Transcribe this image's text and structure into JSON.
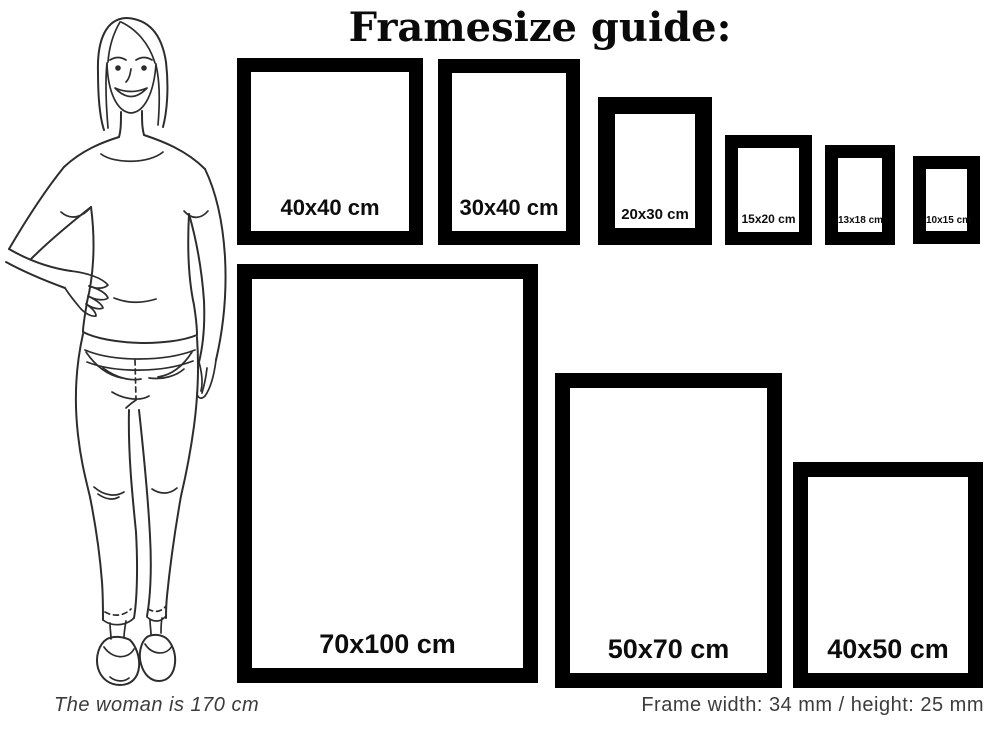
{
  "title": "Framesize guide:",
  "frames": [
    {
      "label": "40x40 cm",
      "width_cm": 40,
      "height_cm": 40
    },
    {
      "label": "30x40 cm",
      "width_cm": 30,
      "height_cm": 40
    },
    {
      "label": "20x30 cm",
      "width_cm": 20,
      "height_cm": 30
    },
    {
      "label": "15x20 cm",
      "width_cm": 15,
      "height_cm": 20
    },
    {
      "label": "13x18 cm",
      "width_cm": 13,
      "height_cm": 18
    },
    {
      "label": "10x15 cm",
      "width_cm": 10,
      "height_cm": 15
    },
    {
      "label": "70x100 cm",
      "width_cm": 70,
      "height_cm": 100
    },
    {
      "label": "50x70 cm",
      "width_cm": 50,
      "height_cm": 70
    },
    {
      "label": "40x50 cm",
      "width_cm": 40,
      "height_cm": 50
    }
  ],
  "footer": {
    "left_note": "The woman is 170 cm",
    "right_note": "Frame width: 34 mm / height: 25 mm"
  },
  "colors": {
    "background": "#ffffff",
    "frame": "#000000",
    "title_text": "#0a0a0a",
    "note_text": "#3c3c3c",
    "line_art": "#2d2d2d"
  }
}
